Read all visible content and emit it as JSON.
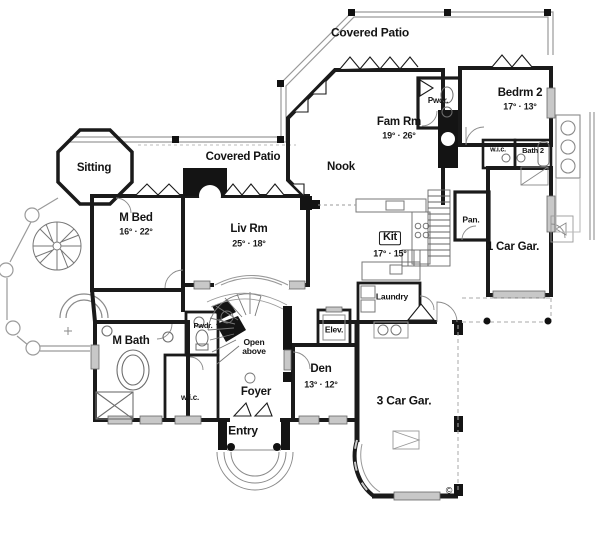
{
  "plan": {
    "type": "architectural first-floor plan",
    "copyright_symbol": "©",
    "wall_color": "#1a1a1a",
    "railing_color": "#9a9a9a",
    "fixture_color": "#6e6e6e",
    "window_bar_color": "#c8c8c8"
  },
  "rooms": {
    "covered_patio_top": {
      "name": "Covered Patio"
    },
    "pwdr_upper": {
      "name": "Pwdr."
    },
    "bedrm2": {
      "name": "Bedrm 2",
      "dims": "17° · 13°"
    },
    "fam_rm": {
      "name": "Fam Rm",
      "dims": "19° · 26°"
    },
    "nook": {
      "name": "Nook"
    },
    "sitting": {
      "name": "Sitting"
    },
    "covered_patio_mid": {
      "name": "Covered Patio"
    },
    "m_bed": {
      "name": "M Bed",
      "dims": "16° · 22°"
    },
    "liv_rm": {
      "name": "Liv Rm",
      "dims": "25° · 18°"
    },
    "kit": {
      "name": "Kit",
      "dims": "17° · 15°"
    },
    "pan": {
      "name": "Pan."
    },
    "one_car_gar": {
      "name": "1 Car Gar."
    },
    "wic_upper": {
      "name": "w.i.c."
    },
    "bath2": {
      "name": "Bath 2"
    },
    "laundry": {
      "name": "Laundry"
    },
    "elev": {
      "name": "Elev."
    },
    "m_bath": {
      "name": "M Bath"
    },
    "pwdr_lower": {
      "name": "Pwdr."
    },
    "open_above": {
      "name": "Open\nabove"
    },
    "wic_lower": {
      "name": "w.i.c."
    },
    "foyer": {
      "name": "Foyer"
    },
    "den": {
      "name": "Den",
      "dims": "13° · 12°"
    },
    "entry": {
      "name": "Entry"
    },
    "three_car_gar": {
      "name": "3 Car Gar."
    }
  }
}
